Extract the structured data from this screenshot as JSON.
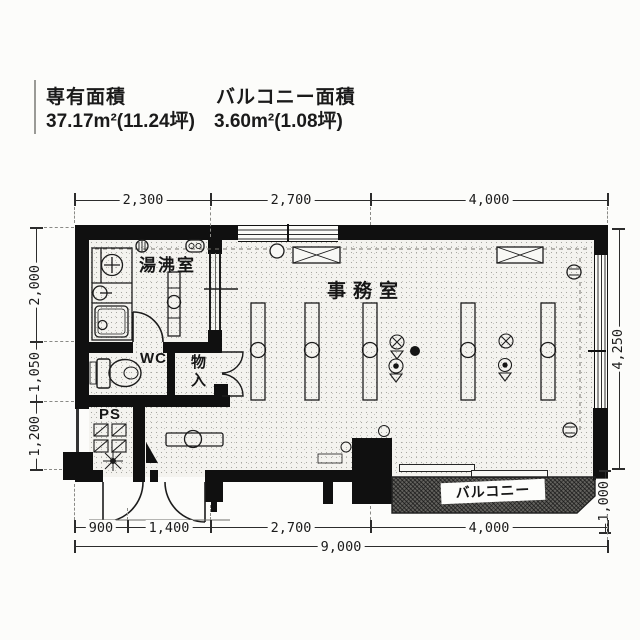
{
  "header": {
    "exclusive_area_label": "専有面積",
    "exclusive_area_value": "37.17m²(11.24坪)",
    "balcony_area_label": "バルコニー面積",
    "balcony_area_value": "3.60m²(1.08坪)"
  },
  "rooms": {
    "kitchenette": "湯沸室",
    "office": "事務室",
    "wc": "WC",
    "storage": "物入",
    "pipe_space": "PS",
    "balcony": "バルコニー"
  },
  "dimensions": {
    "top": [
      "2,300",
      "2,700",
      "4,000"
    ],
    "left": [
      "2,000",
      "1,050",
      "1,200"
    ],
    "right": [
      "4,250",
      "1,000"
    ],
    "bottom": [
      "900",
      "1,400",
      "2,700",
      "4,000"
    ],
    "bottom_total": "9,000"
  },
  "colors": {
    "wall": "#101010",
    "floor": "#f4f3ef",
    "balcony": "#63625e",
    "line": "#2c2c2c",
    "paper": "#fcfcfa"
  }
}
